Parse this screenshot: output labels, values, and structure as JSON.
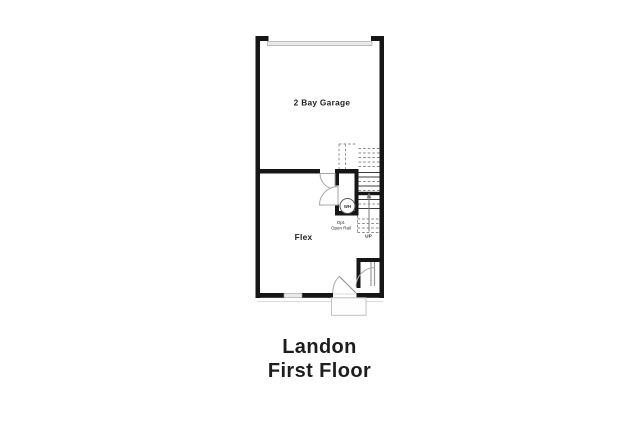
{
  "title": {
    "line1": "Landon",
    "line2": "First Floor"
  },
  "floor_plan": {
    "garage_label": "2 Bay Garage",
    "flex_label": "Flex",
    "water_heater_label": "WH",
    "stairs_note_line1": "Opt.",
    "stairs_note_line2": "Open Rail",
    "up_label": "UP"
  },
  "colors": {
    "wall": "#161616",
    "door_swing": "#a6a6a6",
    "fixture_fill": "#e9e9e9",
    "label_text": "#222222",
    "title_text": "#1d1d1d",
    "background": "#ffffff"
  }
}
